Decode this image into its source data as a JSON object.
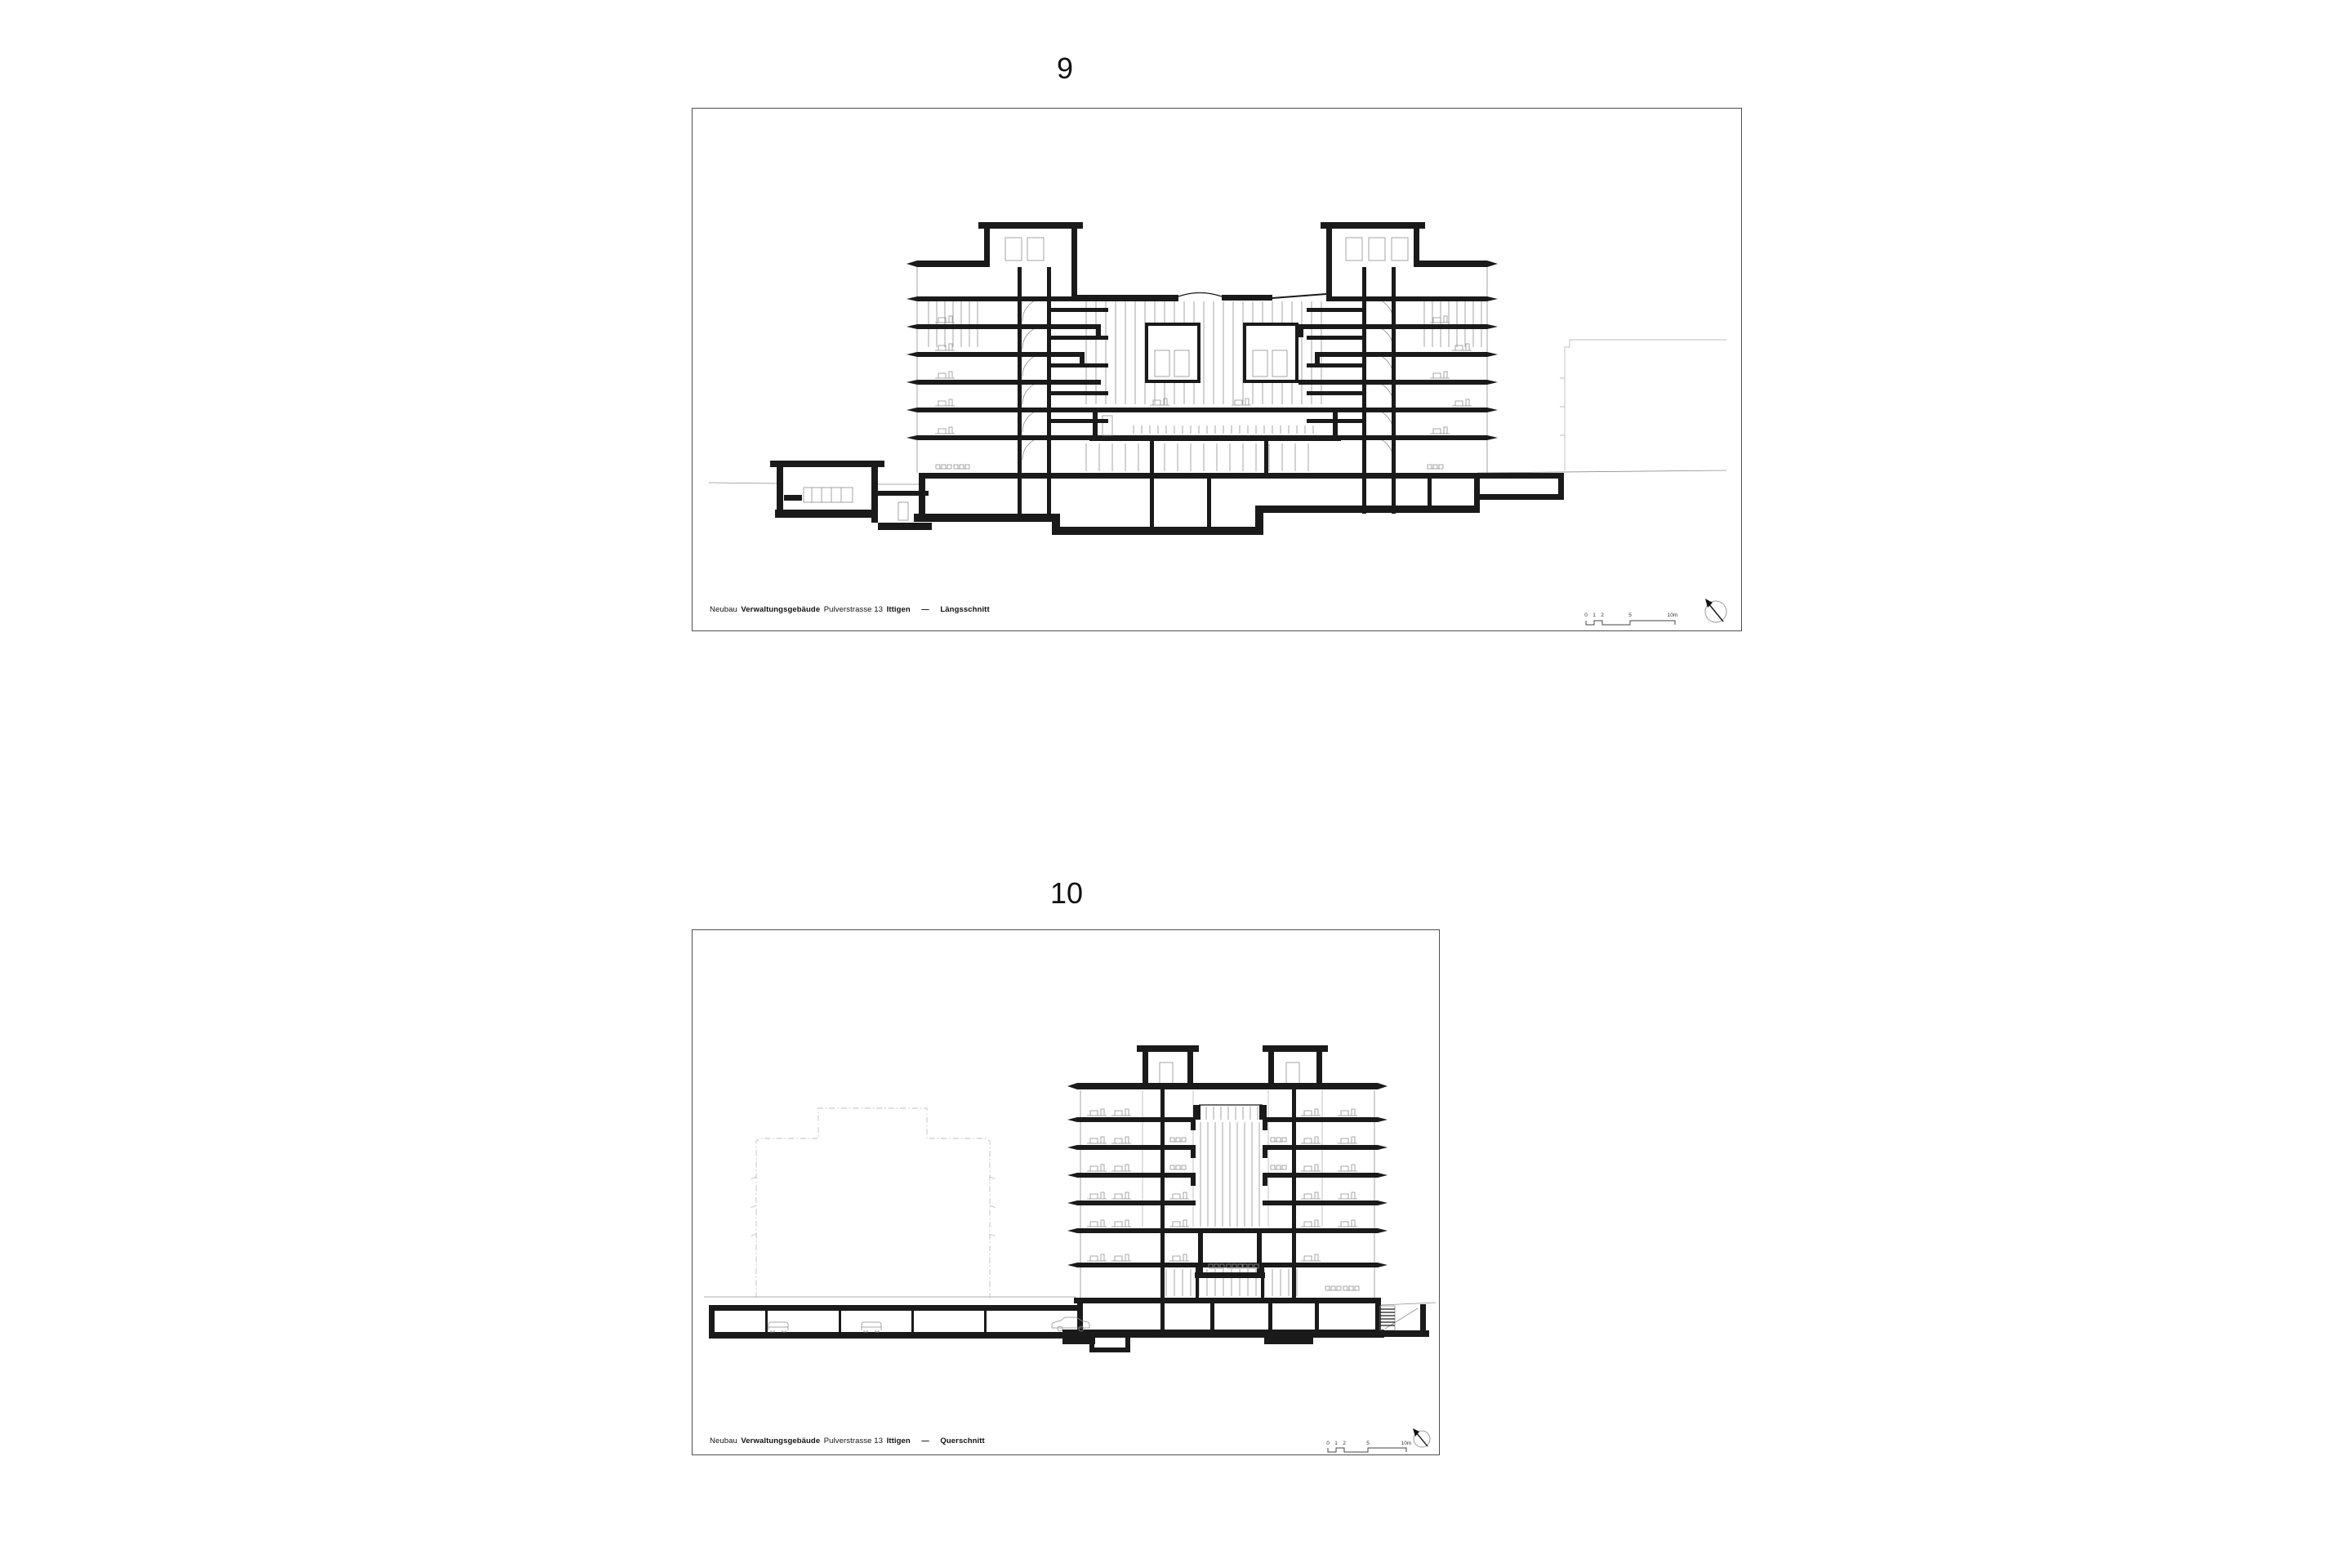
{
  "colors": {
    "paper": "#ffffff",
    "ink": "#1a1a1a",
    "detail_gray": "#8f8f8f",
    "faint_gray": "#bdbdbd",
    "frame_border": "#4f4f4f",
    "text": "#111111"
  },
  "figures": [
    {
      "number": "9",
      "caption": {
        "project": "Neubau",
        "building": "Verwaltungsgebäude",
        "address": "Pulverstrasse 13",
        "city": "Ittigen",
        "separator": "—",
        "view": "Längsschnitt"
      },
      "scale_bar": {
        "labels": [
          "0",
          "1",
          "2",
          "5",
          "10m"
        ]
      },
      "icons": {
        "north_arrow": "compass-north-arrow-icon"
      }
    },
    {
      "number": "10",
      "caption": {
        "project": "Neubau",
        "building": "Verwaltungsgebäude",
        "address": "Pulverstrasse 13",
        "city": "Ittigen",
        "separator": "—",
        "view": "Querschnitt"
      },
      "scale_bar": {
        "labels": [
          "0",
          "1",
          "2",
          "5",
          "10m"
        ]
      },
      "icons": {
        "north_arrow": "compass-north-arrow-icon"
      }
    }
  ]
}
